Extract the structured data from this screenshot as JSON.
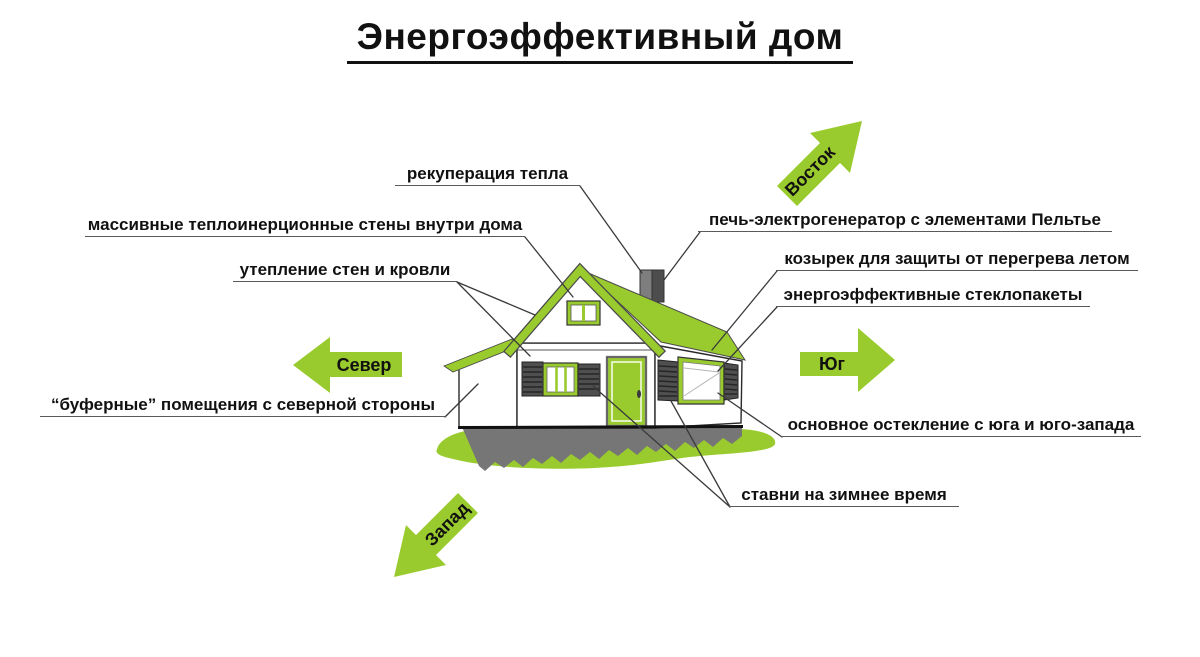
{
  "title": "Энергоэффективный дом",
  "labels": {
    "recuperation": "рекуперация тепла",
    "massive_walls": "массивные теплоинерционные стены внутри дома",
    "insulation": "утепление стен и кровли",
    "stove": "печь-электрогенератор с элементами Пельтье",
    "canopy": "козырек для защиты от перегрева летом",
    "glazing_units": "энергоэффективные стеклопакеты",
    "main_glazing": "основное остекление с юга и юго-запада",
    "buffer_rooms": "“буферные” помещения с северной стороны",
    "shutters": "ставни на зимнее время"
  },
  "compass": {
    "east": "Восток",
    "north": "Север",
    "south": "Юг",
    "west": "Запад"
  },
  "colors": {
    "accent_green": "#9acb2e",
    "shutter_gray": "#4f4f4f",
    "foundation_gray": "#767676",
    "chimney_light": "#7e7e7e",
    "chimney_dark": "#4d4d4d",
    "leader_line": "#3a3a3a",
    "text": "#111111"
  }
}
